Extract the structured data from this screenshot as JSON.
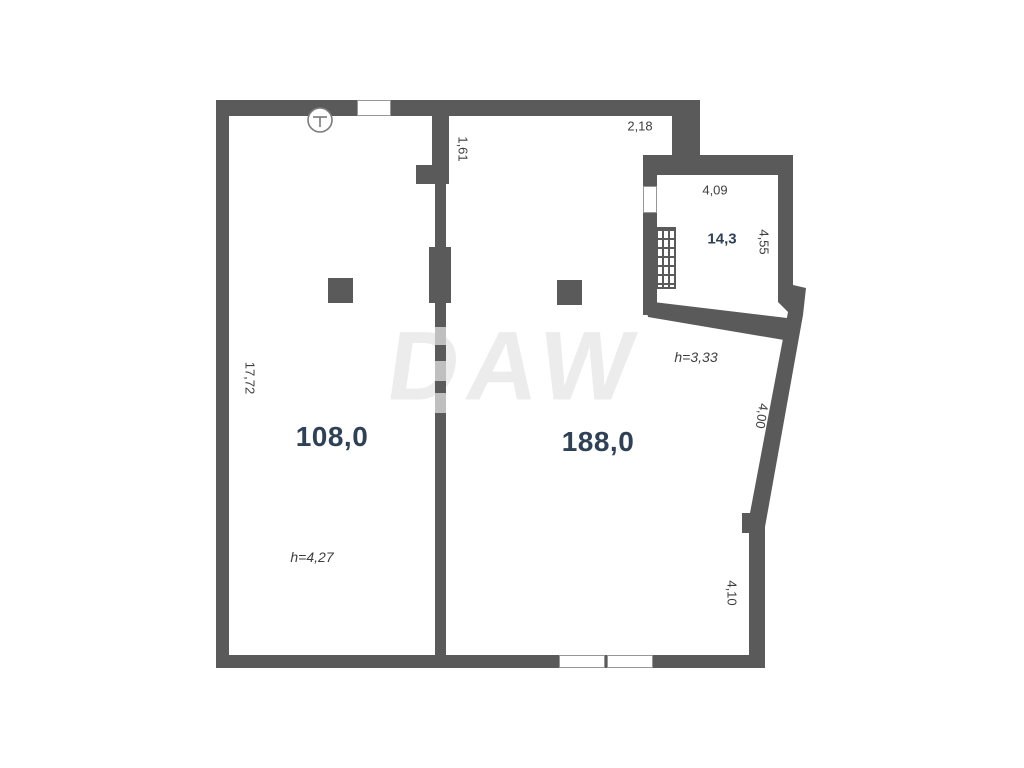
{
  "watermark": "DAW",
  "rooms": {
    "room1": {
      "area": "108,0",
      "ceiling": "h=4,27"
    },
    "room2": {
      "area": "188,0",
      "ceiling": "h=3,33"
    },
    "room3": {
      "area": "14,3"
    }
  },
  "dimensions": {
    "top_recess_width": "2,18",
    "partition_offset": "1,61",
    "room3_width": "4,09",
    "room3_depth": "4,55",
    "left_wall_length": "17,72",
    "diagonal_wall": "4,00",
    "right_wall_lower": "4,10"
  },
  "icons": {
    "fixture_symbol": "circle-with-T"
  },
  "colors": {
    "wall": "#5a5a5a",
    "wall_faded": "#bfbfbf",
    "area_label": "#2e4156",
    "dimension_label": "#3e3e3e",
    "watermark": "#ececec"
  }
}
